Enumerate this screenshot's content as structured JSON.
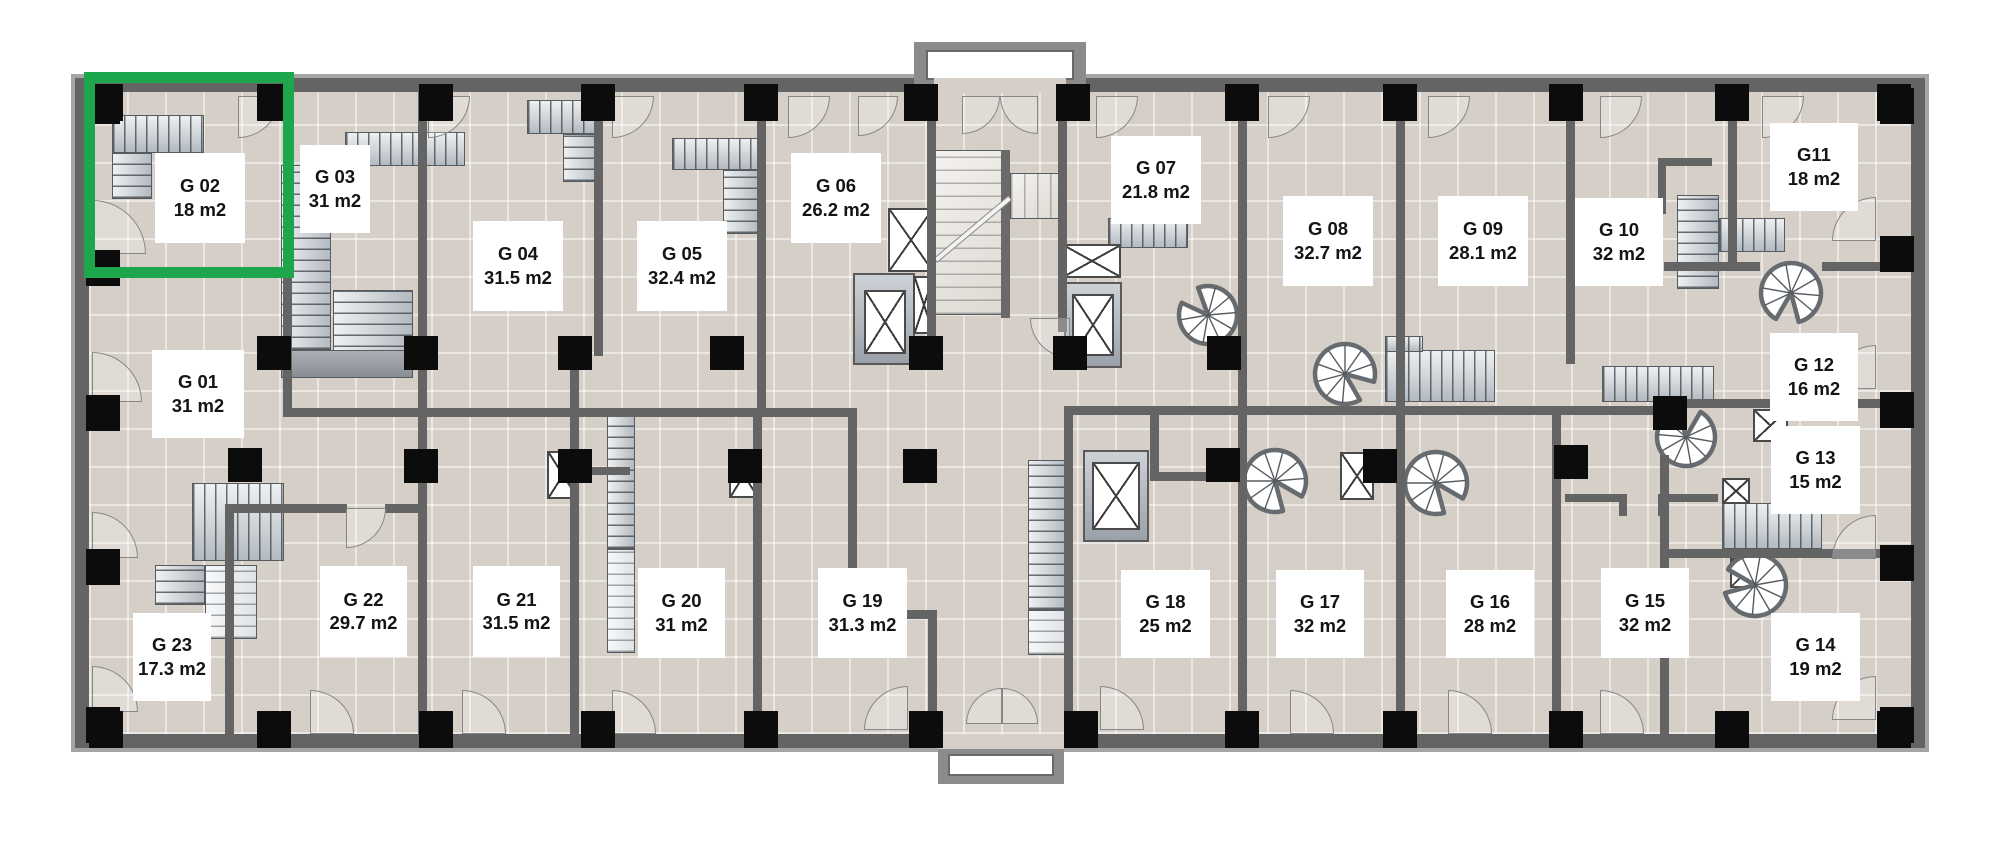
{
  "plan": {
    "type": "floor-plan",
    "area_unit": "m2",
    "unit_count": 23
  },
  "highlight": {
    "unit_id": "G 02",
    "color": "#1ea64c",
    "x": 84,
    "y": 72,
    "w": 210,
    "h": 206
  },
  "colors": {
    "floor": "#d6cfc7",
    "wall": "#646464",
    "column": "#0c0c0c",
    "label_bg": "#ffffff",
    "label_text": "#141414"
  },
  "units": [
    {
      "id": "G 01",
      "area": "31 m2",
      "x": 152,
      "y": 350,
      "w": 92,
      "h": 88
    },
    {
      "id": "G 02",
      "area": "18 m2",
      "x": 155,
      "y": 153,
      "w": 90,
      "h": 90
    },
    {
      "id": "G 03",
      "area": "31 m2",
      "x": 300,
      "y": 145,
      "w": 70,
      "h": 88
    },
    {
      "id": "G 04",
      "area": "31.5 m2",
      "x": 473,
      "y": 221,
      "w": 90,
      "h": 90
    },
    {
      "id": "G 05",
      "area": "32.4 m2",
      "x": 637,
      "y": 221,
      "w": 90,
      "h": 90
    },
    {
      "id": "G 06",
      "area": "26.2 m2",
      "x": 791,
      "y": 153,
      "w": 90,
      "h": 90
    },
    {
      "id": "G 07",
      "area": "21.8 m2",
      "x": 1111,
      "y": 136,
      "w": 90,
      "h": 88
    },
    {
      "id": "G 08",
      "area": "32.7 m2",
      "x": 1283,
      "y": 196,
      "w": 90,
      "h": 90
    },
    {
      "id": "G 09",
      "area": "28.1 m2",
      "x": 1438,
      "y": 196,
      "w": 90,
      "h": 90
    },
    {
      "id": "G 10",
      "area": "32 m2",
      "x": 1575,
      "y": 198,
      "w": 88,
      "h": 88
    },
    {
      "id": "G11",
      "area": "18 m2",
      "x": 1770,
      "y": 123,
      "w": 88,
      "h": 88
    },
    {
      "id": "G 12",
      "area": "16 m2",
      "x": 1770,
      "y": 333,
      "w": 88,
      "h": 88
    },
    {
      "id": "G 13",
      "area": "15 m2",
      "x": 1771,
      "y": 426,
      "w": 89,
      "h": 88
    },
    {
      "id": "G 14",
      "area": "19 m2",
      "x": 1771,
      "y": 613,
      "w": 89,
      "h": 88
    },
    {
      "id": "G 15",
      "area": "32 m2",
      "x": 1601,
      "y": 568,
      "w": 88,
      "h": 90
    },
    {
      "id": "G 16",
      "area": "28 m2",
      "x": 1446,
      "y": 570,
      "w": 88,
      "h": 88
    },
    {
      "id": "G 17",
      "area": "32 m2",
      "x": 1276,
      "y": 570,
      "w": 88,
      "h": 88
    },
    {
      "id": "G 18",
      "area": "25 m2",
      "x": 1121,
      "y": 570,
      "w": 89,
      "h": 88
    },
    {
      "id": "G 19",
      "area": "31.3 m2",
      "x": 818,
      "y": 568,
      "w": 89,
      "h": 90
    },
    {
      "id": "G 20",
      "area": "31 m2",
      "x": 638,
      "y": 568,
      "w": 87,
      "h": 90
    },
    {
      "id": "G 21",
      "area": "31.5 m2",
      "x": 473,
      "y": 566,
      "w": 87,
      "h": 91
    },
    {
      "id": "G 22",
      "area": "29.7 m2",
      "x": 320,
      "y": 566,
      "w": 87,
      "h": 91
    },
    {
      "id": "G 23",
      "area": "17.3 m2",
      "x": 133,
      "y": 613,
      "w": 78,
      "h": 88
    }
  ]
}
